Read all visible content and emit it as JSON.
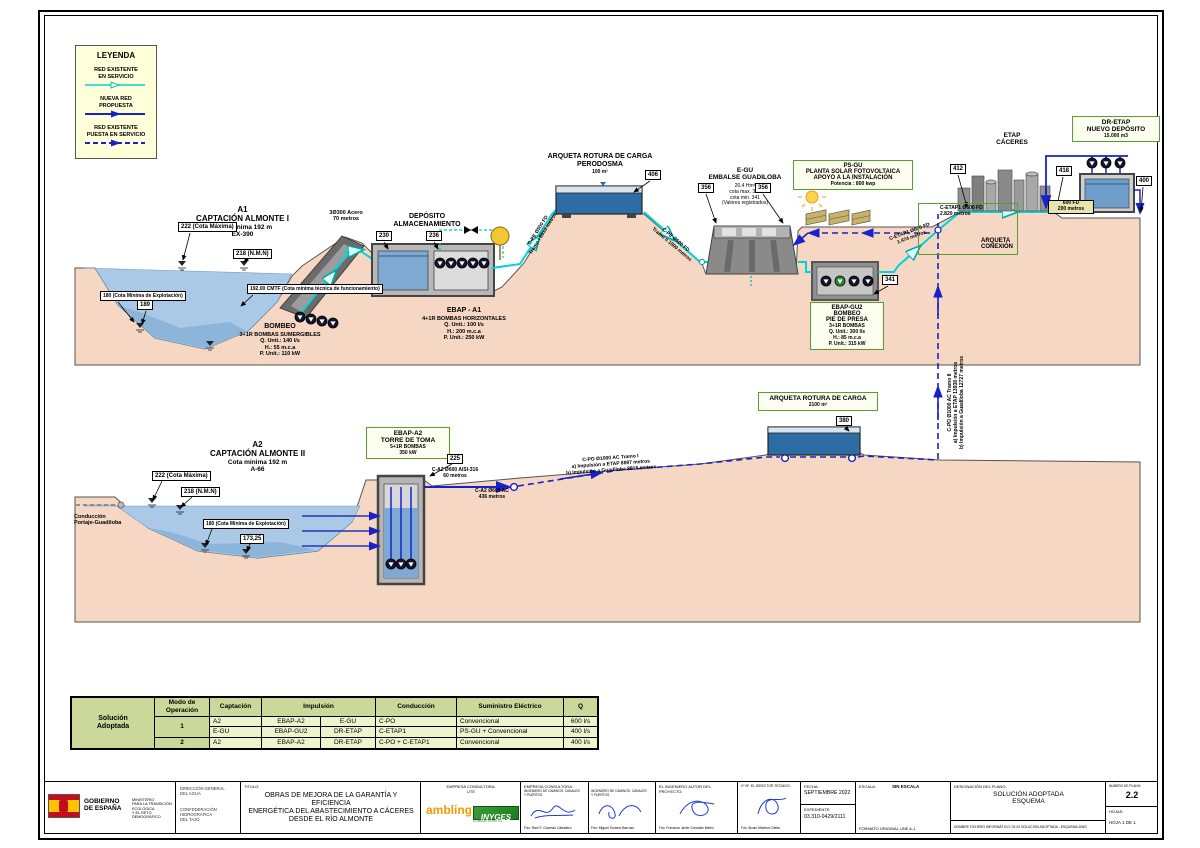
{
  "legend": {
    "title": "LEYENDA",
    "existing": "RED EXISTENTE\nEN SERVICIO",
    "proposed": "NUEVA RED\nPROPUESTA",
    "existing_in_service": "RED EXISTENTE\nPUESTA EN SERVICIO"
  },
  "upper": {
    "a1_title": "A1\nCAPTACIÓN ALMONTE I",
    "a1_sub": "Cota mínima 192 m\nEX-390",
    "tag_222": "222 (Cota Máxima)",
    "tag_218": "218 (N.M.N)",
    "tag_cmtf": "192.00 CMTF (Cota mínima técnica de funcionamiento)",
    "tag_180": "180 (Cota Mínima de Explotación)",
    "tag_189": "189",
    "bombeo_title": "BOMBEO",
    "bombeo_sub": "3+1R BOMBAS SUMERGIBLES\nQ. Unit.: 140 l/s\nH.: 55 m.c.a\nP. Unit.: 110 kW",
    "pipe_acero": "3Ø300 Acero\n70 metros",
    "deposito": "DEPÓSITO\nALMACENAMIENTO",
    "tag_230": "230",
    "tag_236": "236",
    "ebap_a1_title": "EBAP - A1",
    "ebap_a1_sub": "4+1R BOMBAS HORIZONTALES\nQ. Unit.: 100 l/s\nH.: 200 m.c.a\nP. Unit.: 250 kW",
    "arq_perodosma": "ARQUETA ROTURA DE CARGA\nPERODOSMA",
    "arq_perodosma_vol": "100 m²",
    "tag_406": "406",
    "pipe_cpe1": "C-PE Ø500 FD\nTramo I 8913 metros",
    "pipe_cpe2": "C-PE Ø500 FD\nTramo II 1800 metros",
    "egu_title": "E-GU\nEMBALSE GUADILOBA",
    "egu_sub": "20,4 Hm³\ncota max. 361\ncota min. 341\n(Valores registrados)",
    "tag_356a": "356",
    "tag_356b": "356",
    "psgu_title": "PS-GU\nPLANTA SOLAR FOTOVOLTAICA\nAPOYO A LA INSTALACIÓN",
    "psgu_sub": "Potencia : 800 kwp",
    "ebap_gu2_title": "EBAP-GU2\nBOMBEO\nPIE DE PRESA",
    "ebap_gu2_sub": "3+1R BOMBAS\nQ. Unit.: 300 l/s\nH.: 85 m.c.a\nP. Unit.: 315 kW",
    "tag_341": "341",
    "pipe_cetap1_a": "C-ETAP1 Ø600 FD\n1.474 metros",
    "pipe_cetap1_b": "C-ETAP1 Ø600 FD\n2.820 metros",
    "arq_conexion": "ARQUETA\nCONEXIÓN",
    "tag_412": "412",
    "etap": "ETAP\nCÁCERES",
    "dretap_title": "DR-ETAP\nNUEVO DEPÓSITO",
    "dretap_sub": "15.000 m3",
    "tag_418": "418",
    "tag_400": "400",
    "pipe_600fd": "600 FD\n200 metros"
  },
  "lower": {
    "a2_title": "A2\nCAPTACIÓN ALMONTE II",
    "a2_sub": "Cota mínima 192 m\nA-66",
    "tag_222": "222 (Cota Máxima)",
    "tag_218": "218 (N.M.N)",
    "tag_180": "180 (Cota Mínima de Explotación)",
    "tag_173": "173,25",
    "conduccion": "Conducción\nPortaje-Guadiloba",
    "ebap_a2_title": "EBAP-A2\nTORRE DE TOMA",
    "ebap_a2_sub": "5+1R BOMBAS\n350 kW",
    "tag_225": "225",
    "pipe_ca2a": "C-A2 Ø600 AISI-316\n60 metros",
    "pipe_ca2b": "C-A2 Ø600 AC\n436 metros",
    "pipe_cpo1": "C-PO Ø1000 AC Tramo I\na) Impulsión a ETAP 8897 metros\nb) Impulsión a Guadiloba 8915 metros",
    "arq_rotura": "ARQUETA ROTURA DE CARGA",
    "arq_rotura_vol": "2100 m³",
    "tag_380": "380",
    "pipe_cpo2": "C-PO Ø1000 AC Tramo II\na) Impulsión a ETAP 13938 metros\nb) Impulsión a Guadiloba 12727 metros"
  },
  "table": {
    "corner": "Solución\nAdoptada",
    "h_modo": "Modo de\nOperación",
    "h_captacion": "Captación",
    "h_impulsion": "Impulsión",
    "h_conduccion": "Conducción",
    "h_suministro": "Suministro Eléctrico",
    "h_q": "Q",
    "rows": [
      [
        "1",
        "A2",
        "EBAP-A2",
        "E-GU",
        "C-PO",
        "Convencional",
        "600 l/s"
      ],
      [
        "",
        "E-GU",
        "EBAP-GU2",
        "DR-ETAP",
        "C-ETAP1",
        "PS-GU + Convencional",
        "400 l/s"
      ],
      [
        "2",
        "A2",
        "EBAP-A2",
        "DR-ETAP",
        "C-PO + C-ETAP1",
        "Convencional",
        "400 l/s"
      ]
    ]
  },
  "titleblock": {
    "gobierno": "GOBIERNO\nDE ESPAÑA",
    "ministerio": "MINISTERIO\nPARA LA TRANSICIÓN ECOLÓGICA\nY EL RETO DEMOGRÁFICO",
    "direccion": "DIRECCIÓN GENERAL\nDEL AGUA",
    "confederacion": "CONFEDERACIÓN\nHIDROGRÁFICA\nDEL TAJO",
    "titulo_label": "TITULO:",
    "titulo": "OBRAS DE MEJORA DE LA GARANTÍA Y EFICIENCIA\nENERGÉTICA DEL ABASTECIMIENTO A CÁCERES\nDESDE EL RÍO ALMONTE",
    "empresa1_label": "EMPRESA CONSULTORA:\nUTE",
    "logo_ambling": "ambling",
    "logo_inyges": "INYGES",
    "logo_inyges_sub": "CONSULTORES S.L.",
    "empresa2_label": "EMPRESA CONSULTORA:",
    "ing_title_1": "INGENIERO DE CAMINOS, CANALES\nY PUERTOS",
    "ing_title_2": "INGENIERO DE CAMINOS, CANALES\nY PUERTOS",
    "firma1": "Fdo: Raúl F. Guzmán Caballero",
    "firma2": "Fdo: Miguel Soriano Barroso",
    "autor_label": "EL INGENIERO AUTOR DEL\nPROYECTO:",
    "firma3": "Fdo: Francisco Javier González Martín",
    "director_label": "Vº Bº. EL DIRECTOR TÉCNICO:",
    "firma4": "Fdo: Álvaro Martínez Dietta",
    "fecha_label": "FECHA:",
    "fecha": "SEPTIEMBRE 2022",
    "expediente_label": "EXPEDIENTE:",
    "expediente": "03.310-0429/2111",
    "escala_label": "ESCALA:",
    "escala": "SIN ESCALA",
    "formato": "FORMATO ORIGINAL UNE A-1",
    "designacion_label": "DESIGNACIÓN DEL PLANO:",
    "designacion": "SOLUCIÓN ADOPTADA\nESQUEMA",
    "fichero": "NOMBRE FICHERO INFORMÁTICO: 02.02 SOLUCIÓN ADOPTADA - ESQUEMA.DWG",
    "numero_label": "NÚMERO DE PLANO:",
    "numero": "2.2",
    "hojas_label": "HOJAS:",
    "hoja": "HOJA  1  DE  1"
  }
}
